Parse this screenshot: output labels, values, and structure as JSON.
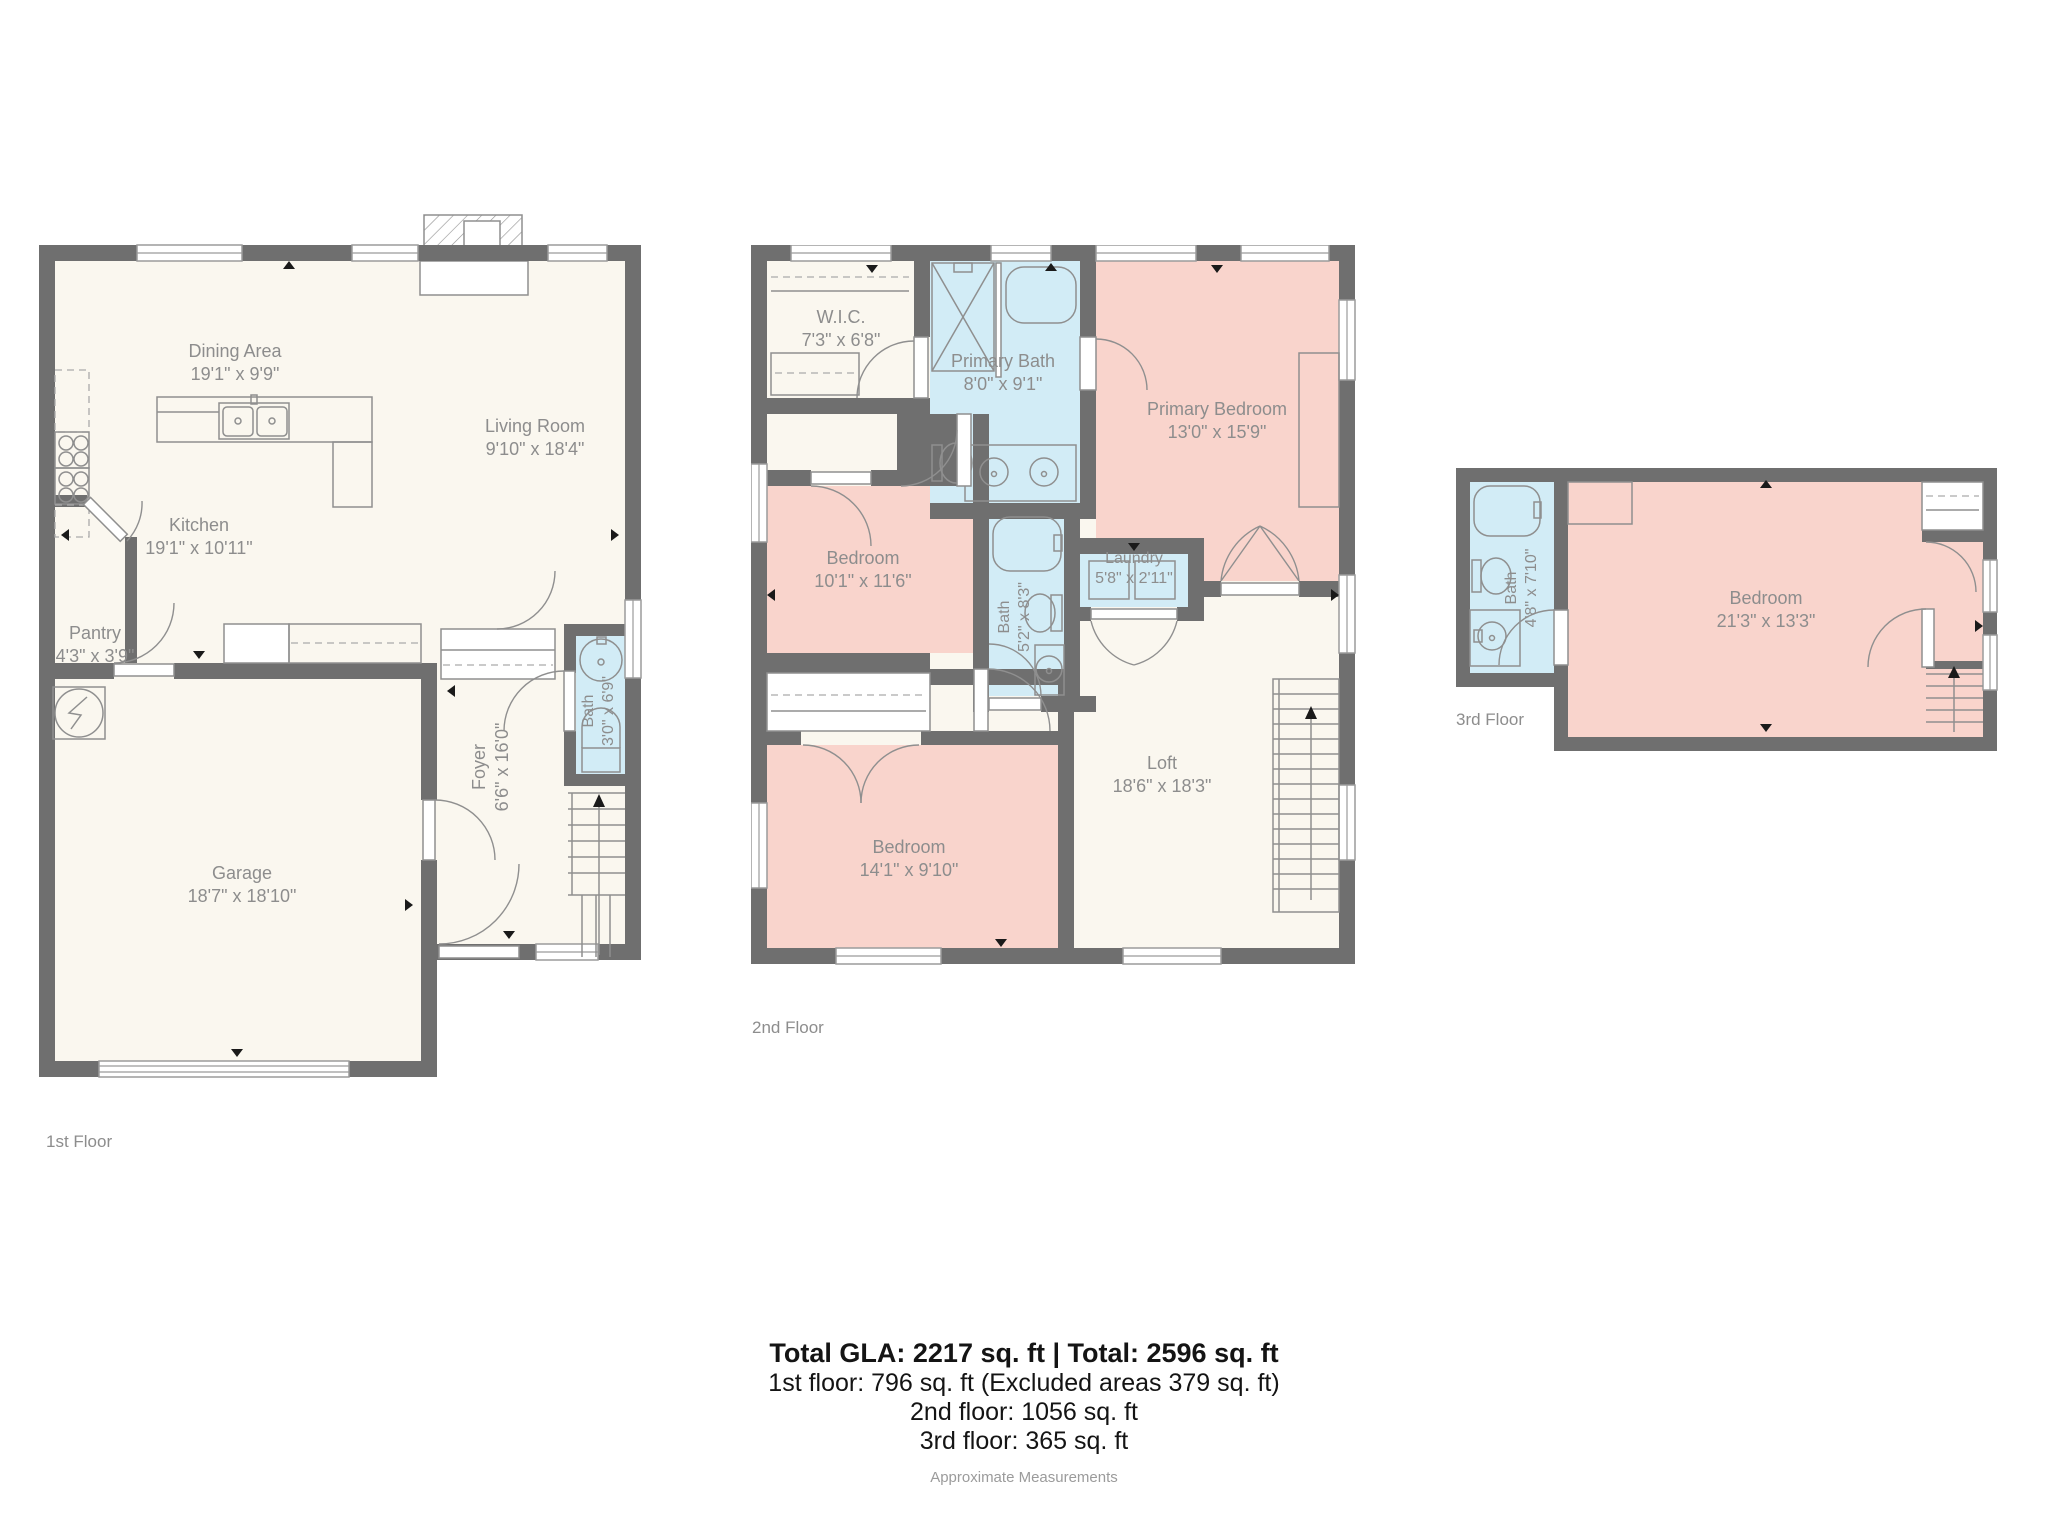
{
  "floor1": {
    "label": "1st Floor",
    "dining": {
      "name": "Dining Area",
      "dims": "19'1\" x 9'9\""
    },
    "living": {
      "name": "Living Room",
      "dims": "9'10\" x 18'4\""
    },
    "kitchen": {
      "name": "Kitchen",
      "dims": "19'1\" x 10'11\""
    },
    "pantry": {
      "name": "Pantry",
      "dims": "4'3\" x 3'9\""
    },
    "garage": {
      "name": "Garage",
      "dims": "18'7\" x 18'10\""
    },
    "foyer": {
      "name": "Foyer",
      "dims": "6'6\" x 16'0\""
    },
    "bath": {
      "name": "Bath",
      "dims": "3'0\" x 6'9\""
    }
  },
  "floor2": {
    "label": "2nd Floor",
    "wic": {
      "name": "W.I.C.",
      "dims": "7'3\" x 6'8\""
    },
    "primary_bath": {
      "name": "Primary Bath",
      "dims": "8'0\" x 9'1\""
    },
    "primary_bedroom": {
      "name": "Primary Bedroom",
      "dims": "13'0\" x 15'9\""
    },
    "bedroom_left": {
      "name": "Bedroom",
      "dims": "10'1\" x 11'6\""
    },
    "bath": {
      "name": "Bath",
      "dims": "5'2\" x 8'3\""
    },
    "laundry": {
      "name": "Laundry",
      "dims": "5'8\" x 2'11\""
    },
    "loft": {
      "name": "Loft",
      "dims": "18'6\" x 18'3\""
    },
    "bedroom_bottom": {
      "name": "Bedroom",
      "dims": "14'1\" x 9'10\""
    }
  },
  "floor3": {
    "label": "3rd Floor",
    "bath": {
      "name": "Bath",
      "dims": "4'8\" x 7'10\""
    },
    "bedroom": {
      "name": "Bedroom",
      "dims": "21'3\" x 13'3\""
    }
  },
  "summary": {
    "total": "Total GLA: 2217 sq. ft | Total: 2596 sq. ft",
    "floor1": "1st floor: 796 sq. ft (Excluded areas 379 sq. ft)",
    "floor2": "2nd floor: 1056 sq. ft",
    "floor3": "3rd floor: 365 sq. ft",
    "note": "Approximate Measurements"
  },
  "colors": {
    "wall": "#6f6f6f",
    "floor": "#faf7ef",
    "bedroom": "#f9d4cc",
    "bath": "#d2ecf6",
    "label": "#8d8d8d"
  }
}
